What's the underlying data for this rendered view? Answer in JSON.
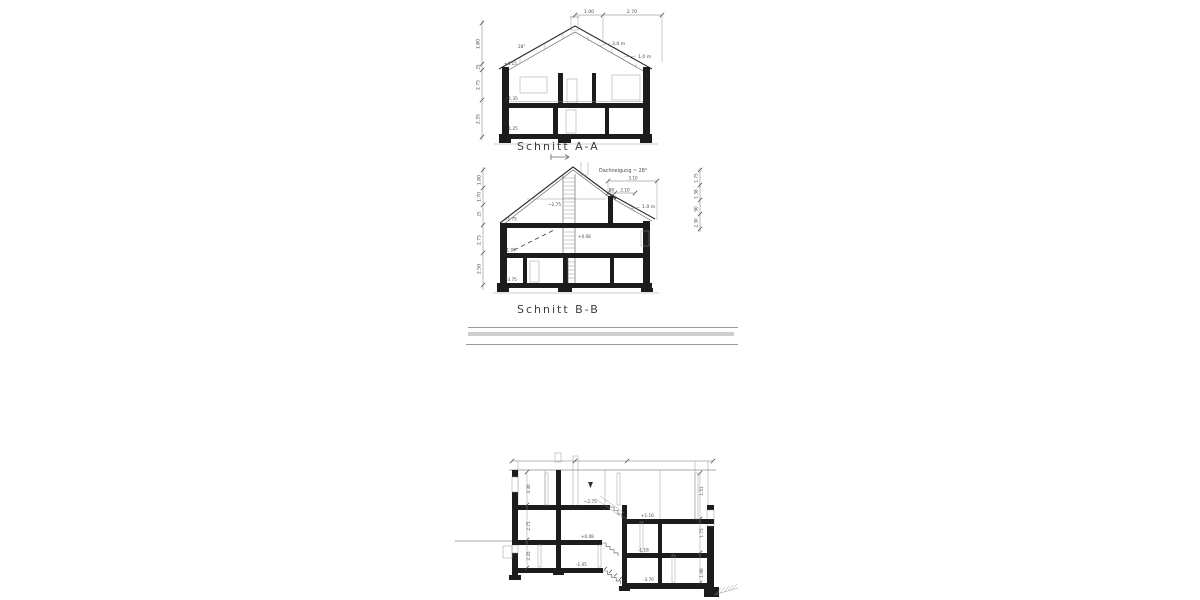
{
  "page": {
    "background": "#ffffff",
    "ink": "#2e2e2e",
    "thin_line": "#8f8f8f",
    "divider": "#cfcfcf"
  },
  "schnitt_aa": {
    "caption": "Schnitt A-A",
    "top_dims": [
      "1.00",
      "2.70"
    ],
    "roof": {
      "angle": "28°",
      "upper_label": "3.0 m",
      "lower_label": "1.0 m"
    },
    "left_dims": [
      "1.80",
      "25",
      "2.75",
      "2.35"
    ],
    "levels": {
      "eaves": "+4.15",
      "upper_floor": "+1.35",
      "basement": "-1.25"
    }
  },
  "schnitt_bb": {
    "caption": "Schnitt B-B",
    "pitch_note": "Dachneigung ~ 28°",
    "top_dim": "3.10",
    "sub_dims": [
      "80",
      "2.10"
    ],
    "roof_label": "1.0 m",
    "left_dims": [
      "1.80",
      "1.70",
      "25",
      "2.75",
      "2.50"
    ],
    "right_dims": [
      "1.75",
      "1.38",
      "90",
      "2.30"
    ],
    "levels": {
      "attic_clearance": "~2.75",
      "attic_floor": "+1.75",
      "stair_landing": "+0.08",
      "ground_floor": "-1.00",
      "basement": "-3.75"
    }
  },
  "section_c": {
    "levels": {
      "top_left": "~2.75",
      "upper_right": "+1.16",
      "mid_left": "+0.08",
      "mid_right": "-1.18",
      "lower_left": "-1.05",
      "bottom_right": "-3.70"
    },
    "left_dims": [
      "3.30",
      "2.75",
      "2.35"
    ],
    "right_dims": [
      "1.51",
      "1.75",
      "1.90"
    ]
  }
}
